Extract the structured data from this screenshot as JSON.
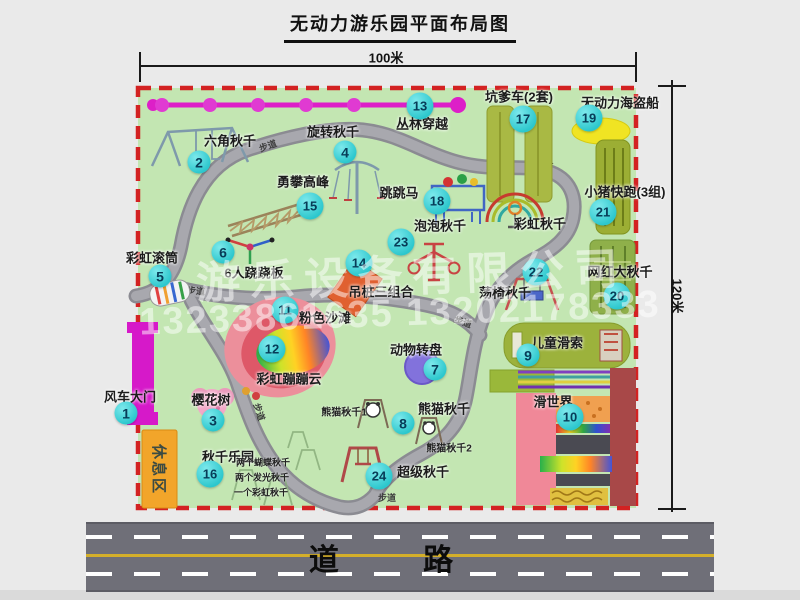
{
  "title": "无动力游乐园平面布局图",
  "dim_width": "100米",
  "dim_height": "120米",
  "road_label": "道 路",
  "path_label": "步道",
  "rest_area_label": "休息区",
  "watermark": {
    "line1": "游乐设备有限公司",
    "line2": "13233861635 13202178333"
  },
  "colors": {
    "border_red": "#d32222",
    "park_green": "#c3e6b2",
    "badge_teal": "#2cc7cd",
    "zipline_magenta": "#dd1fc8",
    "path_gray": "#97979d",
    "rest_orange": "#f2a52a"
  },
  "attractions": [
    {
      "num": "1",
      "label": "风车大门",
      "badge": [
        126,
        413
      ],
      "pos": [
        130,
        396
      ]
    },
    {
      "num": "2",
      "label": "六角秋千",
      "badge": [
        199,
        162
      ],
      "pos": [
        230,
        140
      ]
    },
    {
      "num": "3",
      "label": "樱花树",
      "badge": [
        213,
        420
      ],
      "pos": [
        211,
        399
      ]
    },
    {
      "num": "4",
      "label": "旋转秋千",
      "badge": [
        345,
        152
      ],
      "pos": [
        333,
        131
      ]
    },
    {
      "num": "5",
      "label": "彩虹滚筒",
      "badge": [
        160,
        276
      ],
      "pos": [
        152,
        257
      ]
    },
    {
      "num": "6",
      "label": "6人跷跷板",
      "badge": [
        223,
        252
      ],
      "pos": [
        254,
        272
      ]
    },
    {
      "num": "7",
      "label": "动物转盘",
      "badge": [
        435,
        369
      ],
      "pos": [
        416,
        349
      ]
    },
    {
      "num": "8",
      "label": "熊猫秋千",
      "badge": [
        403,
        423
      ],
      "pos": [
        444,
        408
      ]
    },
    {
      "num": "9",
      "label": "儿童滑索",
      "badge": [
        528,
        355
      ],
      "pos": [
        557,
        342
      ]
    },
    {
      "num": "10",
      "label": "滑世界",
      "badge": [
        570,
        417
      ],
      "pos": [
        553,
        401
      ]
    },
    {
      "num": "11",
      "label": "粉色沙滩",
      "badge": [
        285,
        310
      ],
      "pos": [
        325,
        317
      ]
    },
    {
      "num": "12",
      "label": "彩虹蹦蹦云",
      "badge": [
        272,
        349
      ],
      "pos": [
        289,
        378
      ]
    },
    {
      "num": "13",
      "label": "丛林穿越",
      "badge": [
        420,
        106
      ],
      "pos": [
        422,
        123
      ]
    },
    {
      "num": "14",
      "label": "吊桩三组合",
      "badge": [
        359,
        263
      ],
      "pos": [
        381,
        291
      ]
    },
    {
      "num": "15",
      "label": "勇攀高峰",
      "badge": [
        310,
        206
      ],
      "pos": [
        303,
        181
      ]
    },
    {
      "num": "16",
      "label": "秋千乐园",
      "badge": [
        210,
        474
      ],
      "pos": [
        228,
        456
      ]
    },
    {
      "num": "17",
      "label": "坑爹车(2套)",
      "badge": [
        523,
        119
      ],
      "pos": [
        519,
        96
      ]
    },
    {
      "num": "18",
      "label": "跳跳马",
      "badge": [
        437,
        201
      ],
      "pos": [
        399,
        192
      ]
    },
    {
      "num": "19",
      "label": "无动力海盗船",
      "badge": [
        589,
        118
      ],
      "pos": [
        620,
        102
      ]
    },
    {
      "num": "20",
      "label": "网红大秋千",
      "badge": [
        617,
        296
      ],
      "pos": [
        620,
        271
      ]
    },
    {
      "num": "21",
      "label": "小猪快跑(3组)",
      "badge": [
        603,
        212
      ],
      "pos": [
        625,
        191
      ]
    },
    {
      "num": "22",
      "label": "荡椅秋千",
      "badge": [
        536,
        272
      ],
      "pos": [
        505,
        292
      ]
    },
    {
      "num": "23",
      "label": "泡泡秋千",
      "badge": [
        401,
        242
      ],
      "pos": [
        440,
        225
      ]
    },
    {
      "num": "24",
      "label": "超级秋千",
      "badge": [
        379,
        476
      ],
      "pos": [
        423,
        471
      ]
    },
    {
      "num": "",
      "label": "彩虹秋千",
      "pos": [
        540,
        223
      ]
    }
  ],
  "notes": [
    {
      "text": "熊猫秋千1",
      "pos": [
        344,
        411
      ],
      "size": 10
    },
    {
      "text": "熊猫秋千2",
      "pos": [
        449,
        447
      ],
      "size": 10
    },
    {
      "text": "两个蝴蝶秋千",
      "pos": [
        263,
        462
      ],
      "size": 9
    },
    {
      "text": "两个发光秋千",
      "pos": [
        262,
        477
      ],
      "size": 9
    },
    {
      "text": "一个彩虹秋千",
      "pos": [
        261,
        492
      ],
      "size": 9
    }
  ]
}
